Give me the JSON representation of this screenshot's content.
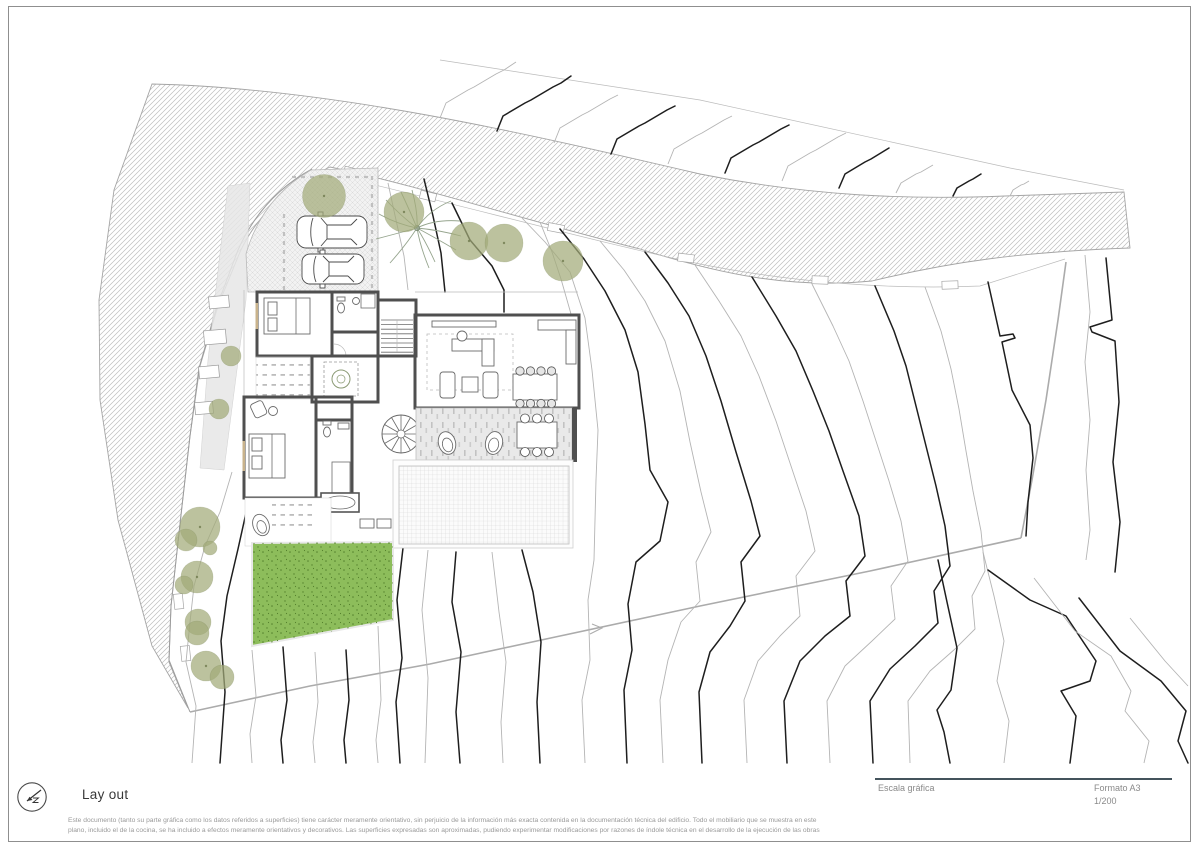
{
  "sheet": {
    "title": "Lay out",
    "scale_bar_label": "Escala gráfica",
    "format_label": "Formato A3",
    "scale_value": "1/200",
    "logo_icon": "north-arrow-icon",
    "disclaimer": {
      "line1": "Este documento (tanto su parte gráfica como los datos referidos a superficies) tiene carácter meramente orientativo, sin perjuicio de la información más exacta contenida en la documentación técnica del edificio. Todo el mobiliario que se muestra en este",
      "line2": "plano, incluido el de la cocina, se ha incluido a efectos meramente orientativos y decorativos. Las superficies expresadas son aproximadas, pudiendo experimentar modificaciones por razones de índole técnica en el desarrollo de la ejecución de las obras"
    }
  },
  "drawing": {
    "kind": "architectural-site-plan",
    "features": [
      "topographic-contour-lines",
      "hatched-road",
      "parked-cars",
      "palm-tree",
      "trees",
      "lawn",
      "swimming-pool",
      "terrace-spiral-stair",
      "furnished-floor-plan"
    ]
  },
  "colors": {
    "contour_major": "#1e1e1e",
    "contour_minor": "#b4b4b4",
    "road_hatch": "#bdbdbd",
    "road_edge": "#a5a5a5",
    "boundary": "#ababab",
    "wall": "#4f4f4f",
    "furniture": "#6b6b6b",
    "terrace": "#e9e9e9",
    "lawn": "#8dbd5b",
    "lawn_dot": "#55812d",
    "tree": "#a2aa79",
    "palm": "#96a58e",
    "divider": "#44535c",
    "text_gray": "#9a9a9a",
    "title_color": "#383838"
  }
}
